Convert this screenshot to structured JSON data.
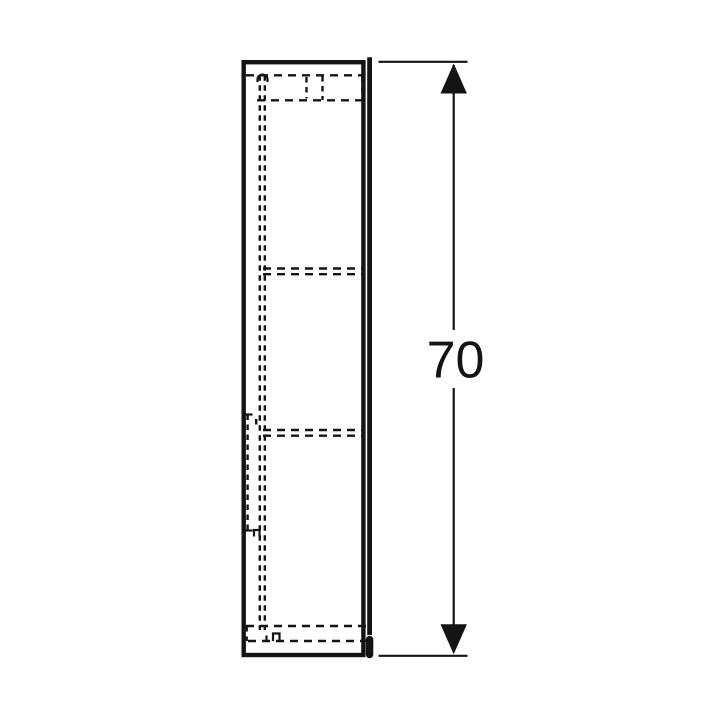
{
  "diagram": {
    "type": "product-dimension-drawing",
    "subject": "tall-cabinet-side-elevation",
    "dimension": {
      "value": "70",
      "orientation": "vertical"
    },
    "colors": {
      "ink": "#141414",
      "background": "#ffffff"
    }
  }
}
